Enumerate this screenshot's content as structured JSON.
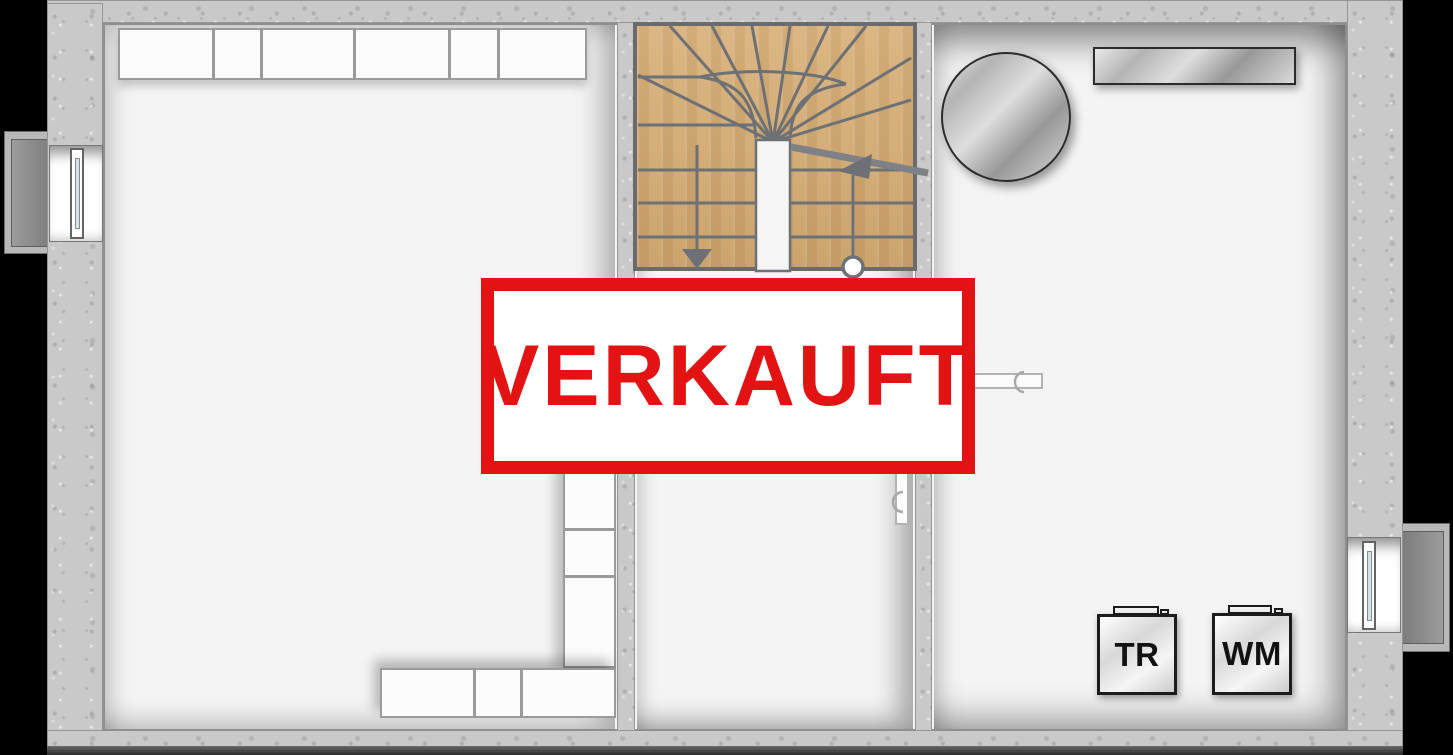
{
  "stamp": {
    "label": "VERKAUFT",
    "border_color": "#e31313",
    "text_color": "#e31313",
    "background": "#ffffff"
  },
  "appliances": {
    "dryer": {
      "label": "TR"
    },
    "washer": {
      "label": "WM"
    }
  },
  "palette": {
    "background": "#000000",
    "concrete_wall": "#c9c9c9",
    "room_floor": "#f4f4f4",
    "wood_tread": "#d8ae75",
    "stair_line": "#6d7175",
    "window_glass": "#cfe3e8",
    "metal_light": "#e9e9e9",
    "metal_dark": "#989898",
    "shelf_outline": "#9b9b9b"
  },
  "fixtures": {
    "staircase": "u-turn-winder-staircase",
    "stair_markers": [
      "walkline-down-arrow",
      "walkline-start-circle",
      "walkline-up-arrow",
      "handrail"
    ],
    "left_room": [
      "top-wall-shelf-run",
      "l-shaped-shelf"
    ],
    "left_wall": [
      "window",
      "light-well"
    ],
    "right_room": [
      "round-tank",
      "wall-mounted-shelf",
      "dryer",
      "washing-machine"
    ],
    "right_wall": [
      "window",
      "light-well"
    ],
    "doors": [
      "door-leaf-to-right-room",
      "door-leaf-in-hall"
    ]
  }
}
